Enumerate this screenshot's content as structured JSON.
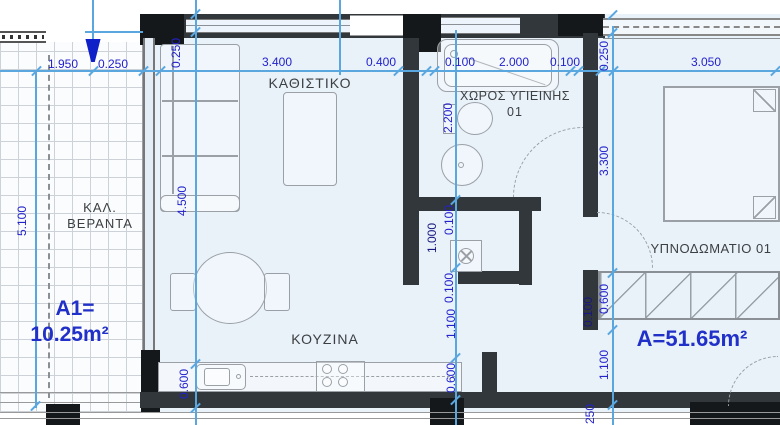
{
  "title": "apartment floor plan",
  "rooms": {
    "living": "ΚΑΘΙΣΤΙΚΟ",
    "bath_line1": "ΧΩΡΟΣ ΥΓΙΕΙΝΗΣ",
    "bath_line2": "01",
    "kitchen": "ΚΟΥΖΙΝΑ",
    "bedroom": "ΥΠΝΟΔΩΜΑΤΙΟ 01",
    "veranda_line1": "ΚΑΛ.",
    "veranda_line2": "ΒΕΡΑΝΤΑ"
  },
  "areas": {
    "veranda_label": "A1=",
    "veranda_value": "10.25m²",
    "apartment_value": "A=51.65m²"
  },
  "dims": {
    "top": [
      "1.950",
      "0.250",
      "3.400",
      "0.400",
      "0.100",
      "2.000",
      "0.100",
      "3.050"
    ],
    "living_v": [
      "0.250",
      "4.500"
    ],
    "veranda_v": [
      "5.100"
    ],
    "bath_v": [
      "2.200",
      "0.100",
      "1.000",
      "0.100",
      "1.100",
      "0.600"
    ],
    "kitchen_v": [
      "0.600"
    ],
    "bedroom_v": [
      "0.250",
      "3.300",
      "0.600",
      "0.100",
      "1.100",
      "0.250"
    ]
  },
  "colors": {
    "dim_line": "#5aa7e0",
    "dim_text": "#2222cc",
    "dim_text_dark": "#191980",
    "wall": "#32373c",
    "area_text": "#2030c8",
    "room_fill": "#e9f1f9",
    "furniture_line": "#9aa0a6",
    "entrance_arrow": "#1020c8"
  }
}
